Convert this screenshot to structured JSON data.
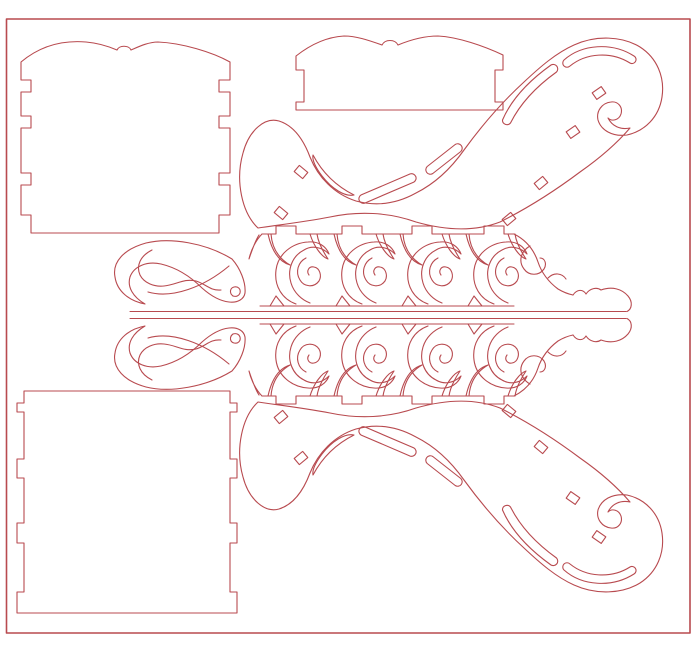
{
  "canvas": {
    "width": 700,
    "height": 668,
    "background": "#ffffff"
  },
  "style": {
    "cut_stroke": "#b84a4f",
    "stroke_width": 1.1,
    "border_stroke_width": 1.6
  },
  "parts": [
    {
      "name": "sheet-border",
      "shapes": [
        {
          "type": "rect",
          "name": "outer-border",
          "x": 6.5,
          "y": 19,
          "w": 683.5,
          "h": 614,
          "w2": 1.6
        }
      ]
    },
    {
      "name": "back-panel-scalloped",
      "shapes": [
        {
          "type": "path",
          "name": "panel-outline",
          "d": "M 21,62 C 40,46 62,40 86,42 C 98,43 110,47 117,50 C 119,45 129,45 131,50 C 138,47 148,42 158,42 C 182,43 212,52 230,62 L 230,80 L 219,80 L 219,92 L 230,92 L 230,116 L 219,116 L 219,128 L 230,128 L 230,173 L 219,173 L 219,185 L 230,185 L 230,215 L 219,215 L 219,233 L 31,233 L 31,215 L 21,215 L 21,185 L 31,185 L 31,173 L 21,173 L 21,128 L 31,128 L 31,116 L 21,116 L 21,92 L 31,92 L 31,80 L 21,80 Z"
        }
      ]
    },
    {
      "name": "front-panel-scalloped",
      "shapes": [
        {
          "type": "path",
          "name": "panel-outline",
          "d": "M 296,56 C 310,45 326,37 344,36 C 356,36 368,40 382,45 C 385,39 395,39 398,45 C 410,40 424,36 438,36 C 458,37 484,46 503,55 L 503,70 L 495,70 L 495,102 L 503,102 L 503,110 L 296,110 L 296,102 L 304,102 L 304,70 L 296,70 Z"
        }
      ]
    },
    {
      "name": "box-panel-plain",
      "shapes": [
        {
          "type": "path",
          "name": "panel-outline",
          "d": "M 24,391 L 230,391 L 230,403 L 237,403 L 237,412 L 230,412 L 230,459 L 237,459 L 237,478 L 230,478 L 230,523 L 237,523 L 237,543 L 230,543 L 230,592 L 237,592 L 237,613 L 17,613 L 17,592 L 24,592 L 24,543 L 17,543 L 17,523 L 24,523 L 24,478 L 17,478 L 17,459 L 24,459 L 24,412 L 17,412 L 17,403 L 24,403 Z"
        }
      ]
    },
    {
      "name": "top-half",
      "shapes": [
        {
          "type": "line",
          "name": "apron-base-line",
          "x1": 130,
          "y1": 311.5,
          "x2": 626,
          "y2": 311.5
        },
        {
          "type": "line",
          "name": "apron-bottom-edge",
          "x1": 260,
          "y1": 306,
          "x2": 514,
          "y2": 306
        },
        {
          "type": "path",
          "name": "apron-feet",
          "d": "M 270,306 L 276,296 L 284,306 M 336,306 L 342,296 L 350,306 M 402,306 L 408,296 L 416,306 M 468,306 L 474,296 L 482,306"
        },
        {
          "type": "path",
          "name": "left-wing-outline",
          "d": "M 232,259 C 206,243 170,237 146,243 C 124,249 112,262 115,277 C 117,291 129,301 145,304 C 133,297 127,287 130,277 C 134,266 147,261 161,264 C 178,268 192,278 202,288 C 211,296 220,301 229,302 C 238,303 244,299 245,293 C 246,282 240,268 232,259 Z"
        },
        {
          "type": "path",
          "name": "left-wing-curl",
          "d": "M 233,296 C 229,293 230,288 234,287 C 238,286 241,289 240,293 C 239,296 236,297 233,296"
        },
        {
          "type": "path",
          "name": "left-wing-inner-line",
          "d": "M 152,250 C 140,256 136,266 140,275 C 144,283 154,287 164,286 C 176,285 184,278 196,281 C 206,284 210,291 221,290"
        },
        {
          "type": "path",
          "name": "left-wing-sweep-line",
          "d": "M 148,292 C 172,299 204,287 229,266"
        },
        {
          "type": "path",
          "name": "apron-top-edge-with-tabs",
          "d": "M 262,234 L 276,234 L 276,226 L 296,226 L 296,234 L 342,234 L 342,226 L 362,226 L 362,234 L 412,234 L 412,226 L 432,226 L 432,234 L 484,234 L 484,226 L 504,226 L 504,234 L 514,234"
        },
        {
          "type": "path",
          "name": "apron-left-leaf",
          "d": "M 262,234 C 256,240 251,250 249,259 C 252,250 255,241 259,235"
        },
        {
          "type": "path",
          "name": "scroll-swag-1",
          "d": "M 268,234 C 272,252 280,262 290,265 C 278,258 272,248 271,234"
        },
        {
          "type": "path",
          "name": "scroll-c-1",
          "d": "M 296,304 C 282,299 274,286 276,270 C 278,254 292,243 308,242 C 318,241 326,246 329,254 C 322,247 312,245 304,250 C 292,256 287,270 291,283 C 294,293 302,300 310,303"
        },
        {
          "type": "path",
          "name": "scroll-spiral-1",
          "d": "M 306,258 C 298,262 295,272 300,280 C 304,287 314,288 319,281 C 322,276 320,268 314,267 C 309,266 306,271 309,275"
        },
        {
          "type": "path",
          "name": "scroll-leaf-1",
          "d": "M 310,234 C 314,247 322,257 328,259 C 322,250 318,241 317,234"
        },
        {
          "type": "path",
          "name": "scroll-swag-2",
          "d": "M 334,234 C 338,252 346,262 356,265 C 344,258 338,248 337,234"
        },
        {
          "type": "path",
          "name": "scroll-c-2",
          "d": "M 362,304 C 348,299 340,286 342,270 C 344,254 358,243 374,242 C 384,241 392,246 395,254 C 388,247 378,245 370,250 C 358,256 353,270 357,283 C 360,293 368,300 376,303"
        },
        {
          "type": "path",
          "name": "scroll-spiral-2",
          "d": "M 372,258 C 364,262 361,272 366,280 C 370,287 380,288 385,281 C 388,276 386,268 380,267 C 375,266 372,271 375,275"
        },
        {
          "type": "path",
          "name": "scroll-leaf-2",
          "d": "M 376,234 C 380,247 388,257 394,259 C 388,250 384,241 383,234"
        },
        {
          "type": "path",
          "name": "scroll-swag-3",
          "d": "M 400,234 C 404,252 412,262 422,265 C 410,258 404,248 403,234"
        },
        {
          "type": "path",
          "name": "scroll-c-3",
          "d": "M 428,304 C 414,299 406,286 408,270 C 410,254 424,243 440,242 C 450,241 458,246 461,254 C 454,247 444,245 436,250 C 424,256 419,270 423,283 C 426,293 434,300 442,303"
        },
        {
          "type": "path",
          "name": "scroll-spiral-3",
          "d": "M 438,258 C 430,262 427,272 432,280 C 436,287 446,288 451,281 C 454,276 452,268 446,267 C 441,266 438,271 441,275"
        },
        {
          "type": "path",
          "name": "scroll-leaf-3",
          "d": "M 442,234 C 446,247 454,257 460,259 C 454,250 450,241 449,234"
        },
        {
          "type": "path",
          "name": "scroll-swag-4",
          "d": "M 466,234 C 470,252 478,262 488,265 C 476,258 470,248 469,234"
        },
        {
          "type": "path",
          "name": "scroll-c-4",
          "d": "M 494,304 C 480,299 472,286 474,270 C 476,254 490,243 506,242 C 516,241 524,246 527,254 C 520,247 510,245 502,250 C 490,256 485,270 489,283 C 492,293 500,300 508,303"
        },
        {
          "type": "path",
          "name": "scroll-spiral-4",
          "d": "M 504,258 C 496,262 493,272 498,280 C 502,287 512,288 517,281 C 520,276 518,268 512,267 C 507,266 504,271 507,275"
        },
        {
          "type": "path",
          "name": "scroll-leaf-4",
          "d": "M 508,234 C 512,247 520,257 526,259 C 520,250 516,241 515,234"
        },
        {
          "type": "path",
          "name": "apron-right-taper-edge",
          "d": "M 514,234 C 526,240 534,250 538,262 C 542,274 550,283 558,289 C 563,292 568,294 573,295"
        },
        {
          "type": "path",
          "name": "apron-right-curl",
          "d": "M 530,246 C 521,251 518,261 524,269 C 529,276 539,276 544,269 C 547,264 545,258 540,258"
        },
        {
          "type": "path",
          "name": "apron-right-small-scroll",
          "d": "M 548,278 C 554,272 562,273 566,279"
        },
        {
          "type": "path",
          "name": "apron-tail-bone-end",
          "d": "M 573,295 C 577,289 583,289 586,294 C 590,288 597,287 601,290 C 612,286 622,289 628,296 C 633,302 632,309 627,311.5"
        },
        {
          "type": "path",
          "name": "runner-outline",
          "d": "M 258,228 C 242,213 235,181 243,153 C 249,130 265,117 279,121 C 295,126 304,141 310,157 C 318,177 334,194 356,201 C 378,207 398,203 416,193 C 436,183 452,167 464,150 C 480,128 500,104 524,82 C 540,67 556,53 574,45 C 596,35 622,36 640,47 C 657,58 665,77 662,97 C 659,117 645,131 627,135 C 612,137 601,130 598,120 C 596,111 602,103 611,102 C 618,101 623,107 621,114 C 619,120 612,122 608,118 C 612,126 620,130 630,128 C 618,142 600,158 580,172 C 556,190 528,208 500,222 C 474,232 444,230 416,222 C 388,212 358,211 330,217 C 304,222 278,225 258,228 Z"
        },
        {
          "type": "path",
          "name": "runner-crescent-slot",
          "d": "M 313,155 C 322,172 336,186 354,195 C 345,197 332,189 322,176 C 316,168 312,160 313,155 Z"
        },
        {
          "type": "path",
          "name": "runner-slot-a",
          "d": "M 364.8,203.1 L 413.8,182.1 A 4.5,4.5 0 0 0 410.2,173.9 L 361.2,194.9 A 4.5,4.5 0 0 0 364.8,203.1 Z"
        },
        {
          "type": "path",
          "name": "runner-slot-b",
          "d": "M 432.8,173.5 L 460.8,151.5 A 4.5,4.5 0 0 0 455.2,144.5 L 427.2,166.5 A 4.5,4.5 0 0 0 432.8,173.5 Z"
        },
        {
          "type": "path",
          "name": "runner-arm-slot",
          "d": "M 502.5,120 C 512,98 530,80 551,65 A 4.5,4.5 0 0 1 556.5,72 C 537,86 521,102 510.5,123 A 4.5,4.5 0 0 1 502.5,120 Z"
        },
        {
          "type": "path",
          "name": "runner-volute-slot",
          "d": "M 564,60 C 582,44 612,42 634,56 A 4,4 0 0 1 630,63 C 611,51 586,53 570,66 A 4,4 0 0 1 564,60 Z"
        },
        {
          "type": "rect",
          "name": "runner-hole-1",
          "x": -5.5,
          "y": -4,
          "w": 11,
          "h": 8,
          "transform": "translate(301 172) rotate(40)"
        },
        {
          "type": "rect",
          "name": "runner-hole-2",
          "x": -5.5,
          "y": -4,
          "w": 11,
          "h": 8,
          "transform": "translate(281 213) rotate(40)"
        },
        {
          "type": "rect",
          "name": "runner-hole-3",
          "x": -5.5,
          "y": -4,
          "w": 11,
          "h": 8,
          "transform": "translate(599 93) rotate(-35)"
        },
        {
          "type": "rect",
          "name": "runner-hole-4",
          "x": -5.5,
          "y": -4,
          "w": 11,
          "h": 8,
          "transform": "translate(573 132) rotate(-35)"
        },
        {
          "type": "rect",
          "name": "runner-hole-5",
          "x": -5.5,
          "y": -4,
          "w": 11,
          "h": 8,
          "transform": "translate(541 183) rotate(-40)"
        },
        {
          "type": "rect",
          "name": "runner-hole-6",
          "x": -5.5,
          "y": -4,
          "w": 11,
          "h": 8,
          "transform": "translate(509 219) rotate(-40)"
        }
      ]
    },
    {
      "name": "bottom-half-mirrored",
      "shapes": [
        {
          "type": "use",
          "name": "mirrored-runner-and-apron",
          "ref": "top-half",
          "transform": "matrix(1 0 0 -1 0 630)"
        }
      ]
    }
  ]
}
